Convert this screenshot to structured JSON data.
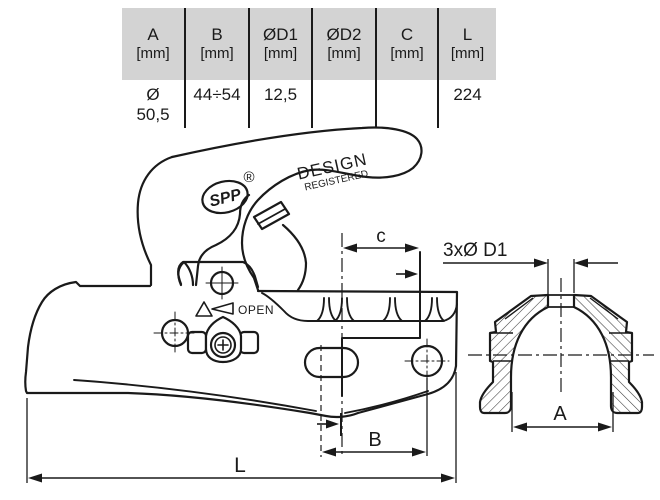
{
  "table": {
    "columns": [
      {
        "name": "A",
        "unit": "[mm]",
        "value_line1": "Ø",
        "value_line2": "50,5"
      },
      {
        "name": "B",
        "unit": "[mm]",
        "value": "44÷54"
      },
      {
        "name": "ØD1",
        "unit": "[mm]",
        "value": "12,5"
      },
      {
        "name": "ØD2",
        "unit": "[mm]",
        "value": ""
      },
      {
        "name": "C",
        "unit": "[mm]",
        "value": ""
      },
      {
        "name": "L",
        "unit": "[mm]",
        "value": "224"
      }
    ]
  },
  "drawing": {
    "brand": "SPP",
    "registered_mark": "®",
    "design_line1": "DESIGN",
    "design_line2": "REGISTERED",
    "open_label": "OPEN",
    "dim_c": "c",
    "dim_d1": "3xØ D1",
    "dim_a": "A",
    "dim_b": "B",
    "dim_l": "L"
  },
  "colors": {
    "line": "#1a1a1a",
    "table_header_bg": "#d3d3d3"
  }
}
